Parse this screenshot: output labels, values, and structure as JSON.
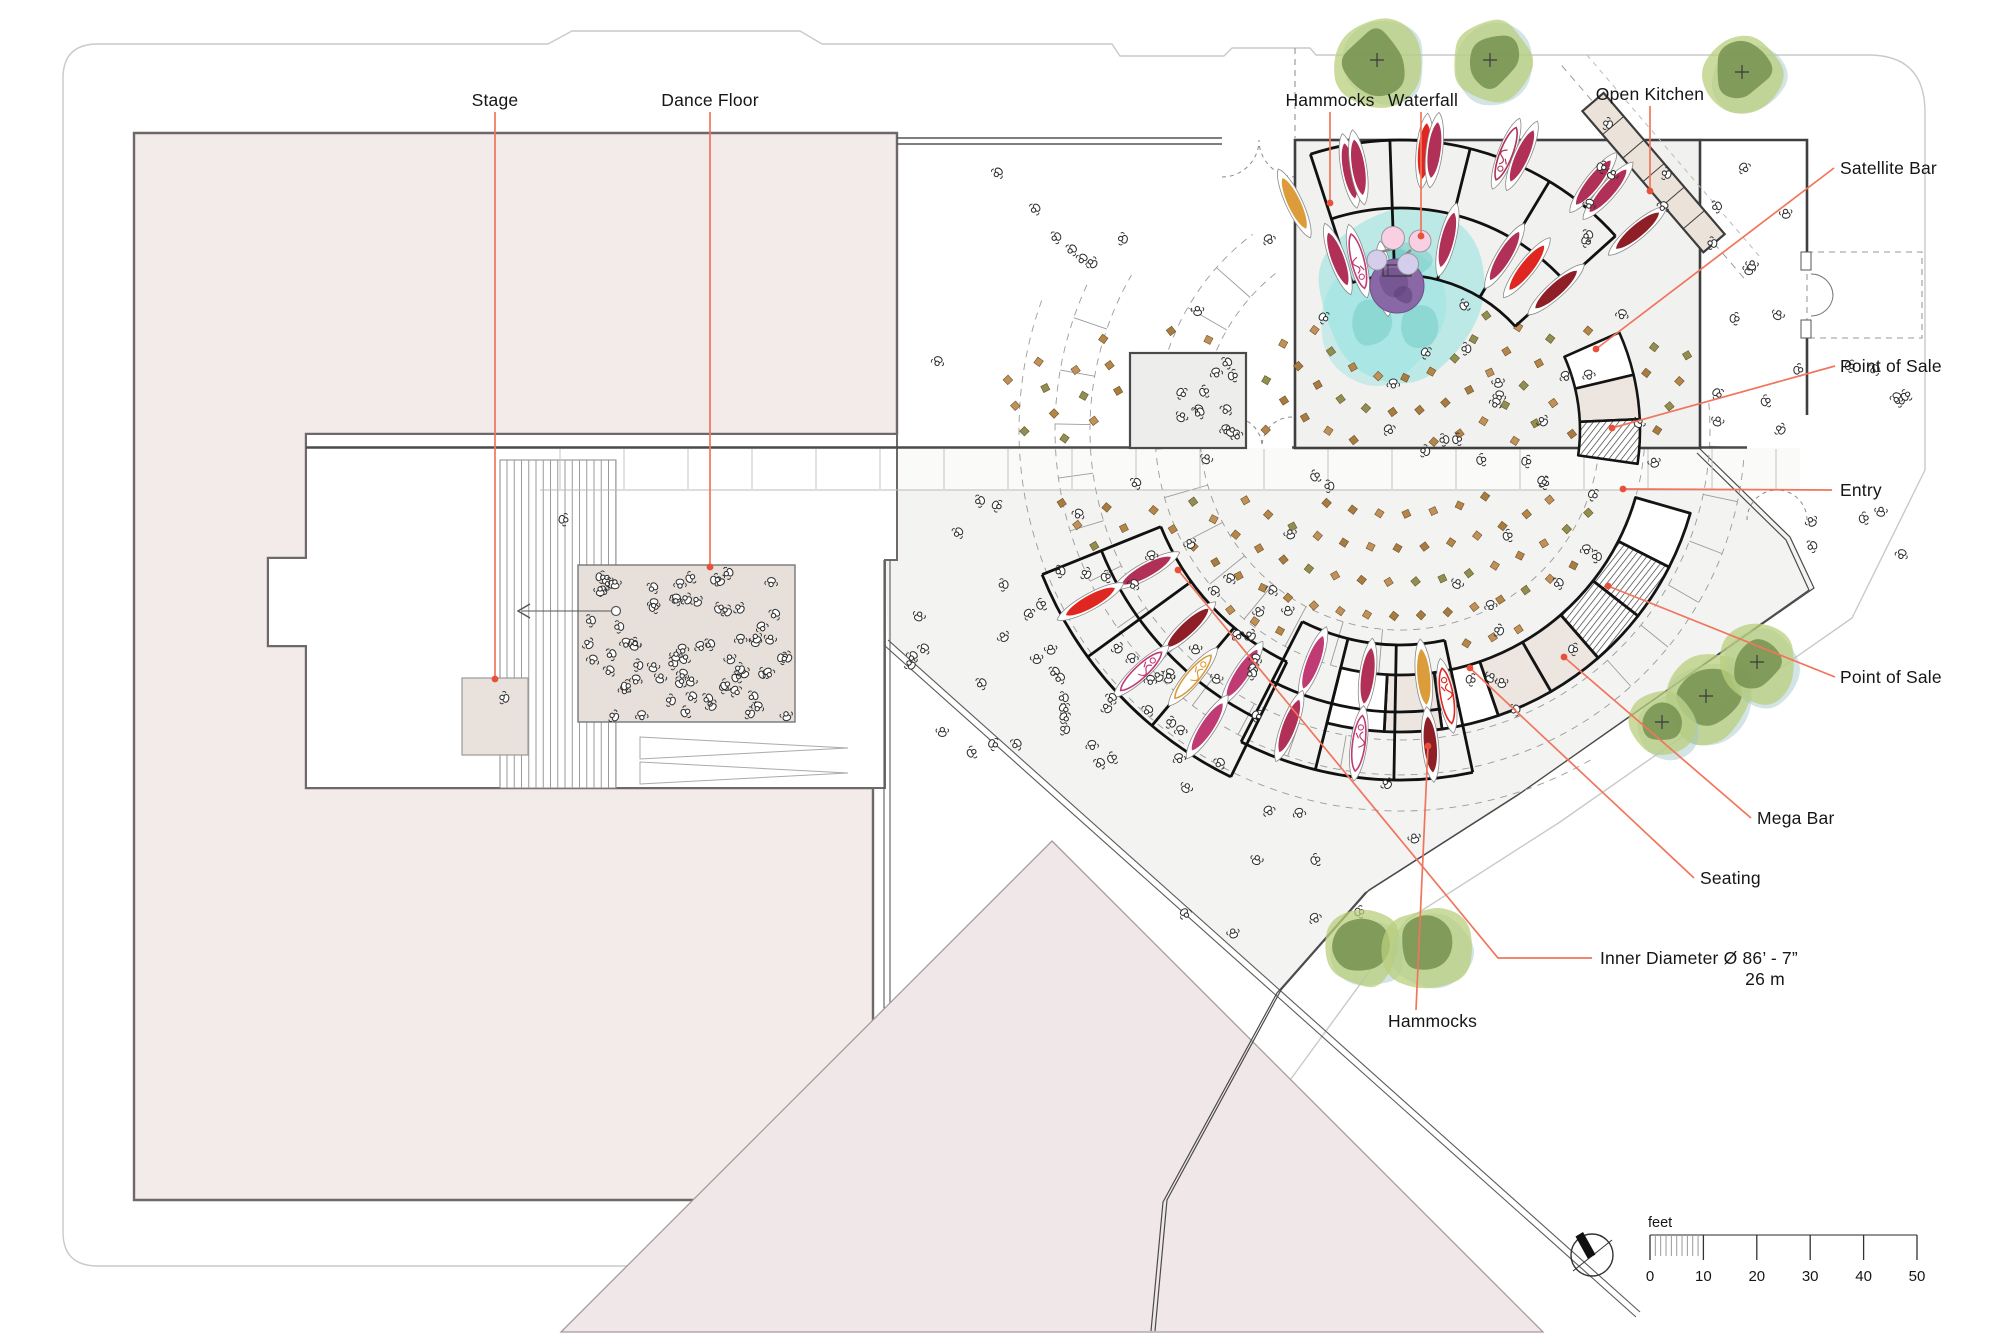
{
  "title": "Event venue floor plan",
  "annotations": {
    "stage": {
      "label": "Stage"
    },
    "dance_floor": {
      "label": "Dance Floor"
    },
    "hammocks_top": {
      "label": "Hammocks"
    },
    "waterfall": {
      "label": "Waterfall"
    },
    "open_kitchen": {
      "label": "Open Kitchen"
    },
    "satellite_bar": {
      "label": "Satellite Bar"
    },
    "point_of_sale_1": {
      "label": "Point of Sale"
    },
    "entry": {
      "label": "Entry"
    },
    "point_of_sale_2": {
      "label": "Point of Sale"
    },
    "mega_bar": {
      "label": "Mega Bar"
    },
    "seating": {
      "label": "Seating"
    },
    "inner_diameter": {
      "label": "Inner Diameter  Ø 86’ - 7”",
      "sub": "26 m"
    },
    "hammocks_bottom": {
      "label": "Hammocks"
    }
  },
  "scale_bar": {
    "unit": "feet",
    "ticks": [
      0,
      10,
      20,
      30,
      40,
      50
    ],
    "px_per_foot": 5.34
  },
  "compass": {
    "type": "north-arrow"
  },
  "palette": {
    "leader": "#f0755c",
    "leader_dot": "#e8503a",
    "crimson": "#b13058",
    "red": "#df2620",
    "dark_red": "#8e1f27",
    "orange": "#dc9c39",
    "magenta": "#c03a74",
    "tree_green": "#b9cf7e",
    "tree_teal": "#9ec4c9",
    "tree_core": "#76904f",
    "water_cyan": "#8fe2de",
    "water_purple": "#8a68a6",
    "seat_brown": "#b5854a",
    "building_pink": "#f2ebea",
    "plaza_gray": "#f3f3f2",
    "counter_beige": "#ebe3da"
  },
  "pods": {
    "g1_outer": [
      [
        245,
        250,
        "orange"
      ],
      [
        259,
        264,
        "crimson"
      ],
      [
        261,
        266,
        "crimson"
      ],
      [
        275,
        280,
        "red"
      ],
      [
        277,
        282,
        "crimson"
      ],
      [
        291,
        296,
        "crimson_p"
      ],
      [
        294,
        300,
        "crimson"
      ],
      [
        308,
        314,
        "crimson"
      ],
      [
        311,
        317,
        "crimson"
      ],
      [
        320,
        310,
        "dark_red"
      ]
    ],
    "g1_inner": [
      [
        250,
        182,
        "crimson"
      ],
      [
        256,
        174,
        "magenta_p"
      ],
      [
        264,
        152,
        "crimson"
      ],
      [
        284,
        196,
        "crimson"
      ],
      [
        301,
        203,
        "crimson"
      ],
      [
        308,
        206,
        "red"
      ],
      [
        318,
        210,
        "dark_red"
      ]
    ],
    "g2": [
      [
        151,
        290,
        "crimson"
      ],
      [
        151,
        354,
        "red"
      ],
      [
        137,
        290,
        "dark_red"
      ],
      [
        137,
        354,
        "magenta_p"
      ],
      [
        123,
        290,
        "magenta"
      ],
      [
        123,
        354,
        "magenta"
      ],
      [
        130,
        322,
        "orange_p"
      ]
    ],
    "g3": [
      [
        84.5,
        248,
        "orange"
      ],
      [
        97.5,
        248,
        "crimson"
      ],
      [
        110.5,
        248,
        "magenta"
      ],
      [
        84.5,
        316,
        "dark_red"
      ],
      [
        97.5,
        316,
        "magenta_p"
      ],
      [
        110.5,
        316,
        "crimson"
      ],
      [
        80,
        270,
        "red_p"
      ]
    ]
  },
  "trees": [
    {
      "x": 1377,
      "y": 60,
      "r": 46
    },
    {
      "x": 1490,
      "y": 60,
      "r": 42
    },
    {
      "x": 1742,
      "y": 72,
      "r": 40
    },
    {
      "x": 1706,
      "y": 696,
      "r": 48
    },
    {
      "x": 1757,
      "y": 662,
      "r": 42
    },
    {
      "x": 1662,
      "y": 722,
      "r": 34
    },
    {
      "x": 1363,
      "y": 948,
      "r": 40
    },
    {
      "x": 1428,
      "y": 948,
      "r": 44
    }
  ],
  "people_regions": [
    {
      "name": "dance-floor-crowd",
      "x": 582,
      "y": 572,
      "w": 208,
      "h": 148,
      "n": 72
    },
    {
      "name": "plaza-mid",
      "x": 905,
      "y": 460,
      "w": 390,
      "h": 300,
      "n": 40
    },
    {
      "name": "plaza-low",
      "x": 1050,
      "y": 650,
      "w": 290,
      "h": 170,
      "n": 16
    },
    {
      "name": "room-floor",
      "x": 1305,
      "y": 300,
      "w": 370,
      "h": 140,
      "n": 16
    },
    {
      "name": "east-corridor",
      "x": 1706,
      "y": 152,
      "w": 95,
      "h": 285,
      "n": 12
    },
    {
      "name": "east-yard",
      "x": 1812,
      "y": 350,
      "w": 100,
      "h": 205,
      "n": 10
    },
    {
      "name": "kitchen-side",
      "x": 1580,
      "y": 120,
      "w": 140,
      "h": 130,
      "n": 9
    },
    {
      "name": "small-room",
      "x": 1138,
      "y": 360,
      "w": 100,
      "h": 80,
      "n": 10
    },
    {
      "name": "entry-band",
      "x": 1300,
      "y": 450,
      "w": 490,
      "h": 38,
      "n": 8
    },
    {
      "name": "top-strip",
      "x": 905,
      "y": 155,
      "w": 370,
      "h": 280,
      "n": 12
    },
    {
      "name": "near-west-hammocks",
      "x": 1000,
      "y": 560,
      "w": 240,
      "h": 190,
      "n": 10
    },
    {
      "name": "south-plaza",
      "x": 1150,
      "y": 770,
      "w": 290,
      "h": 170,
      "n": 8
    },
    {
      "name": "east-seating",
      "x": 1450,
      "y": 460,
      "w": 230,
      "h": 250,
      "n": 13
    },
    {
      "name": "courtyard",
      "x": 540,
      "y": 480,
      "w": 220,
      "h": 210,
      "n": 3
    },
    {
      "name": "stairs-walkers",
      "x": 505,
      "y": 500,
      "w": 110,
      "h": 240,
      "n": 2
    }
  ],
  "seat_rings": {
    "center_note": "rings radiate from waterfall",
    "radii": [
      95,
      129,
      163,
      197,
      231,
      265,
      299,
      333,
      367,
      401
    ],
    "step_px": 27
  }
}
